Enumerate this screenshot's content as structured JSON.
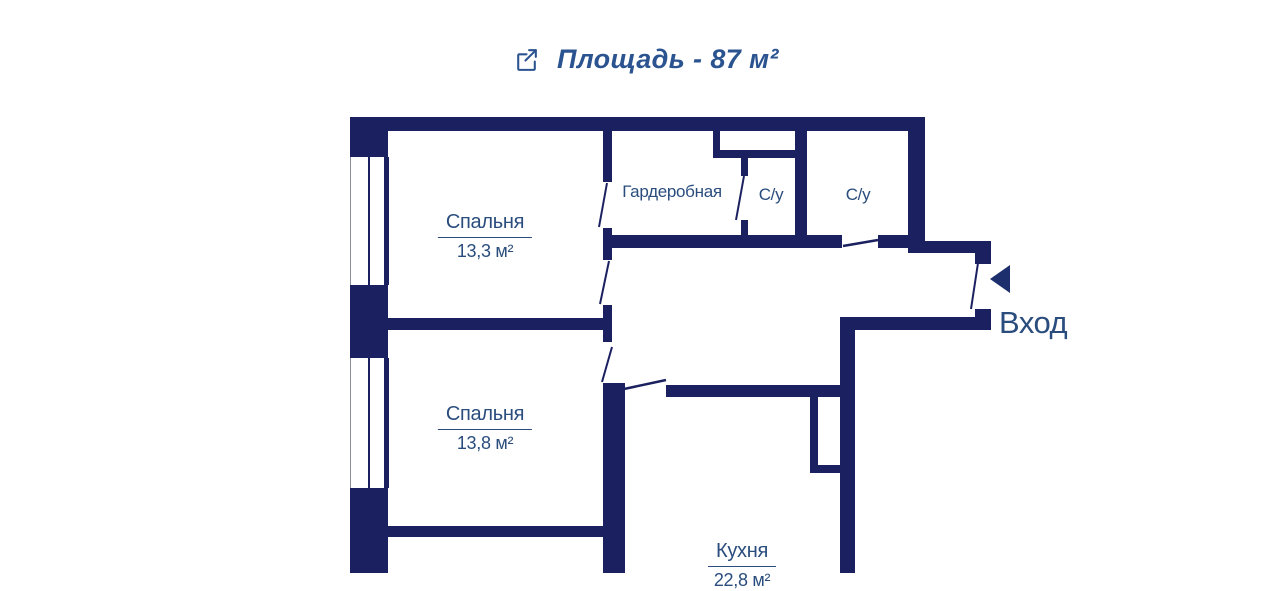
{
  "header": {
    "title": "Площадь - 87 м²",
    "icon": "expand-external-icon"
  },
  "rooms": {
    "bedroom1": {
      "name": "Спальня",
      "area": "13,3 м²"
    },
    "bedroom2": {
      "name": "Спальня",
      "area": "13,8 м²"
    },
    "wardrobe": {
      "name": "Гардеробная"
    },
    "bathroom1": {
      "name": "С/у"
    },
    "bathroom2": {
      "name": "С/у"
    },
    "kitchen": {
      "name": "Кухня",
      "area": "22,8 м²"
    }
  },
  "entrance": {
    "label": "Вход",
    "arrow": "left-triangle-icon"
  },
  "colors": {
    "wall": "#1b2060",
    "room_label": "#2a4d7d",
    "title": "#2a5390"
  }
}
